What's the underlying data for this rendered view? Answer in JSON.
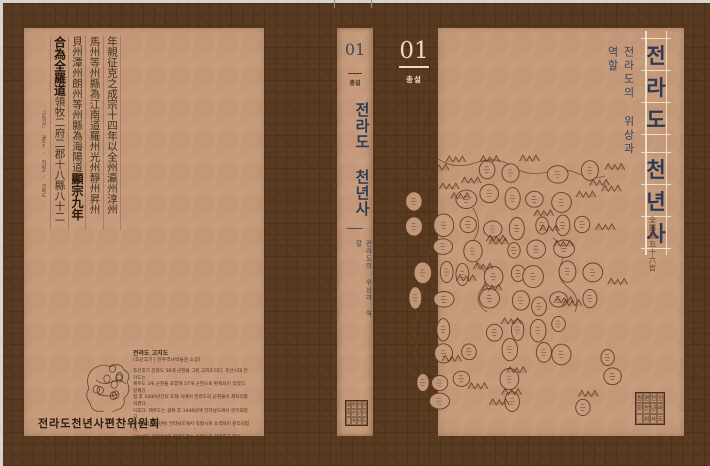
{
  "document_title": "전라도 천년사 — 북 재킷 펼침면",
  "volume": {
    "no": "01",
    "label": "총설"
  },
  "title": "전라도 천년사",
  "subtitle": "전라도의 위상과 역할",
  "publisher": "전라도천년사편찬위원회",
  "front_cover": {
    "title_chars": [
      "전",
      "라",
      "도",
      "",
      "천",
      "년",
      "사"
    ],
    "map_inscription": "全羅道五十六官"
  },
  "back_cover": {
    "calligraphy": {
      "columns": [
        [
          {
            "t": "年親征克之成宗十四年以全州瀛州淳州",
            "b": false
          }
        ],
        [
          {
            "t": "馬州等州縣為江南道羅州光州靜州昇州",
            "b": false
          }
        ],
        [
          {
            "t": "貝州潭州朗州等州縣為海陽道",
            "b": false
          },
          {
            "t": "顯宗九年",
            "b": true
          }
        ],
        [
          {
            "t": "合為全羅道",
            "b": true
          },
          {
            "t": "領牧二府二郡十八縣八十二",
            "b": false
          }
        ]
      ],
      "citation": "『고려사』 권57, 지리2, 전라도"
    },
    "map_caption": {
      "heading": "전라도 고지도",
      "source": "(조선후기 | 전주역사박물관 소장)",
      "body_lines": [
        "조선후기 전라도 56개 군현을 그린 고지도이다. 조선시대 전라도는",
        "제주도 3개 군현을 포함해 57개 군현으로 편제되어 있었다. 일제강",
        "점 후 1000년간의 도제 속에서 전라도의 군현들이 제자리를 지켰다.",
        "이후다. 제주도는 광복 후 1946년에 전라남도에서 분리되었고",
        "광주는 1986년에 전라남도에서 직할시로 승격되어 분리되었다",
        "오늘날도 1000년의 전라도라는 이름으로 전해지고 있다"
      ]
    }
  },
  "seal": {
    "columns": [
      "전라도",
      "천년사",
      "편찬위",
      "원회"
    ]
  },
  "colors": {
    "jacket_brown": "#57391f",
    "panel_tan": "#c79c7d",
    "title_navy": "#2e3a52",
    "cream": "#ecdcbf",
    "map_ink": "#5e3a1f"
  }
}
